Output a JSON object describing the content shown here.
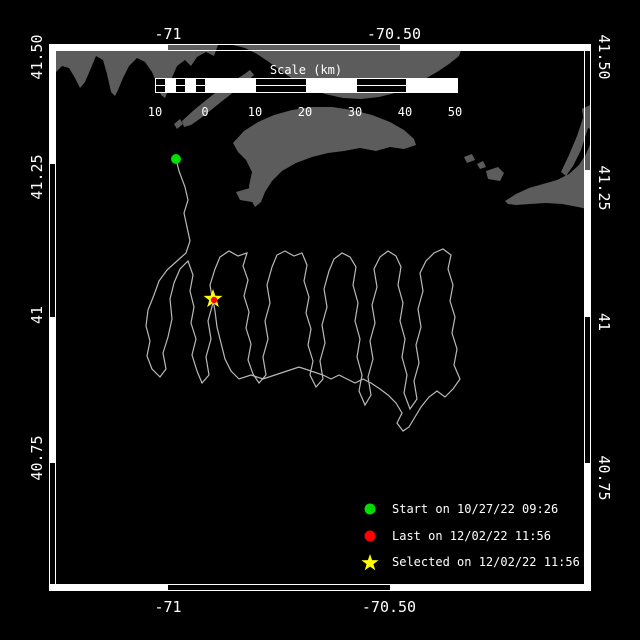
{
  "colors": {
    "background": "#000000",
    "frame": "#ffffff",
    "land": "#5c5c5c",
    "track": "#b9b9b9",
    "text": "#ffffff",
    "start_marker": "#00dd00",
    "last_marker": "#ff0000",
    "selected_marker": "#ffff00"
  },
  "axes": {
    "top": [
      {
        "label": "-71",
        "x": 168,
        "y": 34
      },
      {
        "label": "-70.50",
        "x": 394,
        "y": 34
      }
    ],
    "bottom": [
      {
        "label": "-71",
        "x": 168,
        "y": 607
      },
      {
        "label": "-70.50",
        "x": 389,
        "y": 607
      }
    ],
    "left": [
      {
        "label": "41.50",
        "x": 37,
        "y": 57
      },
      {
        "label": "41.25",
        "x": 37,
        "y": 177
      },
      {
        "label": "41",
        "x": 37,
        "y": 315
      },
      {
        "label": "40.75",
        "x": 37,
        "y": 458
      }
    ],
    "right": [
      {
        "label": "41.50",
        "x": 604,
        "y": 57
      },
      {
        "label": "41.25",
        "x": 604,
        "y": 188
      },
      {
        "label": "41",
        "x": 604,
        "y": 322
      },
      {
        "label": "40.75",
        "x": 604,
        "y": 478
      }
    ]
  },
  "scalebar": {
    "title": "Scale (km)",
    "title_x": 306,
    "title_y": 70,
    "x": 155,
    "y": 78,
    "height": 14,
    "segments": [
      {
        "x": 155,
        "w": 10,
        "style": "lined"
      },
      {
        "x": 165,
        "w": 10,
        "style": "solid"
      },
      {
        "x": 175,
        "w": 10,
        "style": "lined"
      },
      {
        "x": 185,
        "w": 10,
        "style": "solid"
      },
      {
        "x": 195,
        "w": 10,
        "style": "lined"
      },
      {
        "x": 205,
        "w": 50,
        "style": "solid"
      },
      {
        "x": 255,
        "w": 51,
        "style": "lined"
      },
      {
        "x": 306,
        "w": 50,
        "style": "solid"
      },
      {
        "x": 356,
        "w": 50,
        "style": "lined"
      },
      {
        "x": 406,
        "w": 51,
        "style": "solid"
      }
    ],
    "labels": [
      {
        "text": "10",
        "x": 155
      },
      {
        "text": "0",
        "x": 205
      },
      {
        "text": "10",
        "x": 255
      },
      {
        "text": "20",
        "x": 305
      },
      {
        "text": "30",
        "x": 355
      },
      {
        "text": "40",
        "x": 405
      },
      {
        "text": "50",
        "x": 455
      }
    ],
    "labels_y": 112
  },
  "legend": {
    "items": [
      {
        "marker": "circle",
        "color": "#00dd00",
        "label": "Start on 10/27/22 09:26",
        "y": 509
      },
      {
        "marker": "circle",
        "color": "#ff0000",
        "label": "Last on 12/02/22 11:56",
        "y": 536
      },
      {
        "marker": "star",
        "color": "#ffff00",
        "label": "Selected on 12/02/22 11:56",
        "y": 562
      }
    ]
  },
  "markers": {
    "start": {
      "x": 176,
      "y": 159,
      "r": 5
    },
    "last": {
      "x": 214,
      "y": 300,
      "r": 3.2
    },
    "selected": {
      "x": 213,
      "y": 299,
      "outer_r": 10,
      "inner_r": 4
    }
  },
  "map": {
    "frame": {
      "outer": {
        "x": 49.5,
        "y": 44.5,
        "w": 541,
        "h": 546
      },
      "inner": {
        "x": 55.5,
        "y": 50.5,
        "w": 529,
        "h": 534
      },
      "white_segments": [
        {
          "x": 50,
          "y": 45,
          "w": 118,
          "h": 6
        },
        {
          "x": 400,
          "y": 45,
          "w": 190,
          "h": 6
        },
        {
          "x": 50,
          "y": 584,
          "w": 118,
          "h": 6
        },
        {
          "x": 390,
          "y": 584,
          "w": 200,
          "h": 6
        },
        {
          "x": 50,
          "y": 45,
          "w": 6,
          "h": 119
        },
        {
          "x": 50,
          "y": 317,
          "w": 6,
          "h": 146
        },
        {
          "x": 585,
          "y": 170,
          "w": 6,
          "h": 147
        },
        {
          "x": 585,
          "y": 463,
          "w": 6,
          "h": 127
        }
      ]
    },
    "land": [
      [
        50,
        45,
        218,
        45,
        214,
        56,
        206,
        52,
        197,
        57,
        191,
        66,
        185,
        60,
        177,
        66,
        171,
        80,
        167,
        93,
        165,
        98,
        161,
        95,
        157,
        84,
        152,
        72,
        145,
        62,
        137,
        58,
        129,
        66,
        123,
        78,
        118,
        90,
        115,
        96,
        111,
        92,
        107,
        74,
        103,
        60,
        96,
        56,
        91,
        68,
        85,
        82,
        80,
        88,
        75,
        78,
        69,
        68,
        62,
        66,
        56,
        72,
        50,
        78
      ],
      [
        233,
        45,
        463,
        45,
        459,
        56,
        449,
        64,
        437,
        72,
        423,
        80,
        409,
        88,
        395,
        93,
        379,
        97,
        361,
        99,
        343,
        98,
        325,
        94,
        309,
        88,
        294,
        80,
        281,
        71,
        269,
        62,
        257,
        54,
        245,
        48
      ],
      [
        182,
        121,
        194,
        110,
        205,
        101,
        215,
        93,
        225,
        86,
        235,
        80,
        243,
        75,
        250,
        70,
        254,
        75,
        246,
        82,
        238,
        88,
        230,
        95,
        221,
        102,
        211,
        110,
        201,
        118,
        191,
        125,
        184,
        127
      ],
      [
        174,
        124,
        180,
        119,
        183,
        124,
        177,
        129
      ],
      [
        233,
        143,
        244,
        131,
        258,
        122,
        274,
        115,
        292,
        110,
        312,
        107,
        332,
        107,
        352,
        110,
        372,
        115,
        390,
        122,
        404,
        130,
        414,
        139,
        416,
        145,
        404,
        149,
        390,
        147,
        376,
        151,
        360,
        148,
        344,
        151,
        328,
        153,
        312,
        157,
        296,
        163,
        282,
        171,
        272,
        181,
        265,
        192,
        261,
        202,
        255,
        207,
        250,
        198,
        249,
        186,
        252,
        172,
        246,
        160,
        238,
        152
      ],
      [
        236,
        192,
        250,
        188,
        256,
        194,
        252,
        202,
        240,
        200
      ],
      [
        505,
        201,
        516,
        194,
        529,
        188,
        543,
        184,
        557,
        180,
        569,
        174,
        579,
        165,
        586,
        154,
        590,
        145,
        592,
        143,
        592,
        210,
        578,
        207,
        562,
        204,
        546,
        203,
        530,
        204,
        516,
        205,
        508,
        204
      ],
      [
        583,
        118,
        590,
        122,
        581,
        150,
        573,
        166,
        566,
        176,
        561,
        172,
        569,
        155,
        577,
        136
      ],
      [
        582,
        109,
        592,
        104,
        592,
        131,
        584,
        124
      ],
      [
        486,
        171,
        498,
        167,
        504,
        173,
        500,
        181,
        488,
        179
      ],
      [
        464,
        157,
        472,
        154,
        475,
        160,
        467,
        163
      ],
      [
        477,
        164,
        483,
        161,
        486,
        167,
        480,
        169
      ]
    ],
    "track": [
      [
        176,
        159
      ],
      [
        179,
        171
      ],
      [
        185,
        187
      ],
      [
        188,
        200
      ],
      [
        184,
        213
      ],
      [
        187,
        227
      ],
      [
        190,
        241
      ],
      [
        186,
        253
      ],
      [
        177,
        261
      ],
      [
        167,
        270
      ],
      [
        159,
        281
      ],
      [
        154,
        295
      ],
      [
        148,
        310
      ],
      [
        146,
        326
      ],
      [
        150,
        341
      ],
      [
        147,
        356
      ],
      [
        152,
        369
      ],
      [
        160,
        377
      ],
      [
        166,
        369
      ],
      [
        163,
        353
      ],
      [
        168,
        337
      ],
      [
        172,
        319
      ],
      [
        170,
        299
      ],
      [
        174,
        283
      ],
      [
        180,
        269
      ],
      [
        188,
        261
      ],
      [
        193,
        275
      ],
      [
        190,
        291
      ],
      [
        194,
        307
      ],
      [
        191,
        323
      ],
      [
        196,
        339
      ],
      [
        192,
        355
      ],
      [
        197,
        371
      ],
      [
        202,
        383
      ],
      [
        209,
        375
      ],
      [
        206,
        357
      ],
      [
        211,
        339
      ],
      [
        208,
        321
      ],
      [
        213,
        303
      ],
      [
        210,
        285
      ],
      [
        215,
        269
      ],
      [
        220,
        257
      ],
      [
        229,
        251
      ],
      [
        238,
        256
      ],
      [
        247,
        253
      ],
      [
        243,
        266
      ],
      [
        248,
        280
      ],
      [
        244,
        296
      ],
      [
        249,
        312
      ],
      [
        246,
        328
      ],
      [
        251,
        344
      ],
      [
        248,
        360
      ],
      [
        253,
        374
      ],
      [
        259,
        383
      ],
      [
        266,
        375
      ],
      [
        263,
        357
      ],
      [
        268,
        339
      ],
      [
        265,
        321
      ],
      [
        270,
        303
      ],
      [
        267,
        285
      ],
      [
        272,
        267
      ],
      [
        277,
        255
      ],
      [
        285,
        251
      ],
      [
        294,
        256
      ],
      [
        302,
        253
      ],
      [
        307,
        265
      ],
      [
        304,
        281
      ],
      [
        309,
        297
      ],
      [
        306,
        313
      ],
      [
        311,
        329
      ],
      [
        308,
        345
      ],
      [
        313,
        361
      ],
      [
        310,
        375
      ],
      [
        316,
        387
      ],
      [
        323,
        379
      ],
      [
        320,
        361
      ],
      [
        325,
        343
      ],
      [
        322,
        325
      ],
      [
        327,
        307
      ],
      [
        324,
        289
      ],
      [
        329,
        271
      ],
      [
        334,
        259
      ],
      [
        342,
        253
      ],
      [
        350,
        257
      ],
      [
        356,
        267
      ],
      [
        353,
        285
      ],
      [
        358,
        303
      ],
      [
        355,
        321
      ],
      [
        360,
        339
      ],
      [
        357,
        357
      ],
      [
        362,
        375
      ],
      [
        359,
        391
      ],
      [
        365,
        405
      ],
      [
        371,
        395
      ],
      [
        368,
        377
      ],
      [
        373,
        359
      ],
      [
        370,
        341
      ],
      [
        375,
        323
      ],
      [
        372,
        305
      ],
      [
        377,
        287
      ],
      [
        374,
        269
      ],
      [
        380,
        257
      ],
      [
        388,
        251
      ],
      [
        396,
        256
      ],
      [
        401,
        267
      ],
      [
        398,
        285
      ],
      [
        403,
        303
      ],
      [
        400,
        321
      ],
      [
        405,
        339
      ],
      [
        402,
        357
      ],
      [
        407,
        375
      ],
      [
        404,
        393
      ],
      [
        410,
        409
      ],
      [
        417,
        399
      ],
      [
        414,
        381
      ],
      [
        419,
        363
      ],
      [
        416,
        345
      ],
      [
        421,
        327
      ],
      [
        418,
        309
      ],
      [
        423,
        291
      ],
      [
        420,
        273
      ],
      [
        426,
        261
      ],
      [
        434,
        253
      ],
      [
        443,
        249
      ],
      [
        451,
        255
      ],
      [
        448,
        269
      ],
      [
        453,
        285
      ],
      [
        450,
        301
      ],
      [
        455,
        317
      ],
      [
        452,
        333
      ],
      [
        457,
        349
      ],
      [
        454,
        365
      ],
      [
        460,
        379
      ],
      [
        453,
        389
      ],
      [
        445,
        397
      ],
      [
        437,
        391
      ],
      [
        429,
        397
      ],
      [
        421,
        407
      ],
      [
        415,
        417
      ],
      [
        409,
        427
      ],
      [
        403,
        431
      ],
      [
        397,
        423
      ],
      [
        402,
        413
      ],
      [
        396,
        403
      ],
      [
        388,
        395
      ],
      [
        380,
        389
      ],
      [
        371,
        383
      ],
      [
        363,
        379
      ],
      [
        355,
        383
      ],
      [
        347,
        379
      ],
      [
        339,
        375
      ],
      [
        331,
        379
      ],
      [
        323,
        375
      ],
      [
        311,
        371
      ],
      [
        299,
        367
      ],
      [
        287,
        371
      ],
      [
        275,
        375
      ],
      [
        263,
        379
      ],
      [
        251,
        375
      ],
      [
        239,
        379
      ],
      [
        231,
        371
      ],
      [
        225,
        359
      ],
      [
        221,
        343
      ],
      [
        217,
        327
      ],
      [
        215,
        311
      ],
      [
        213,
        300
      ]
    ]
  }
}
